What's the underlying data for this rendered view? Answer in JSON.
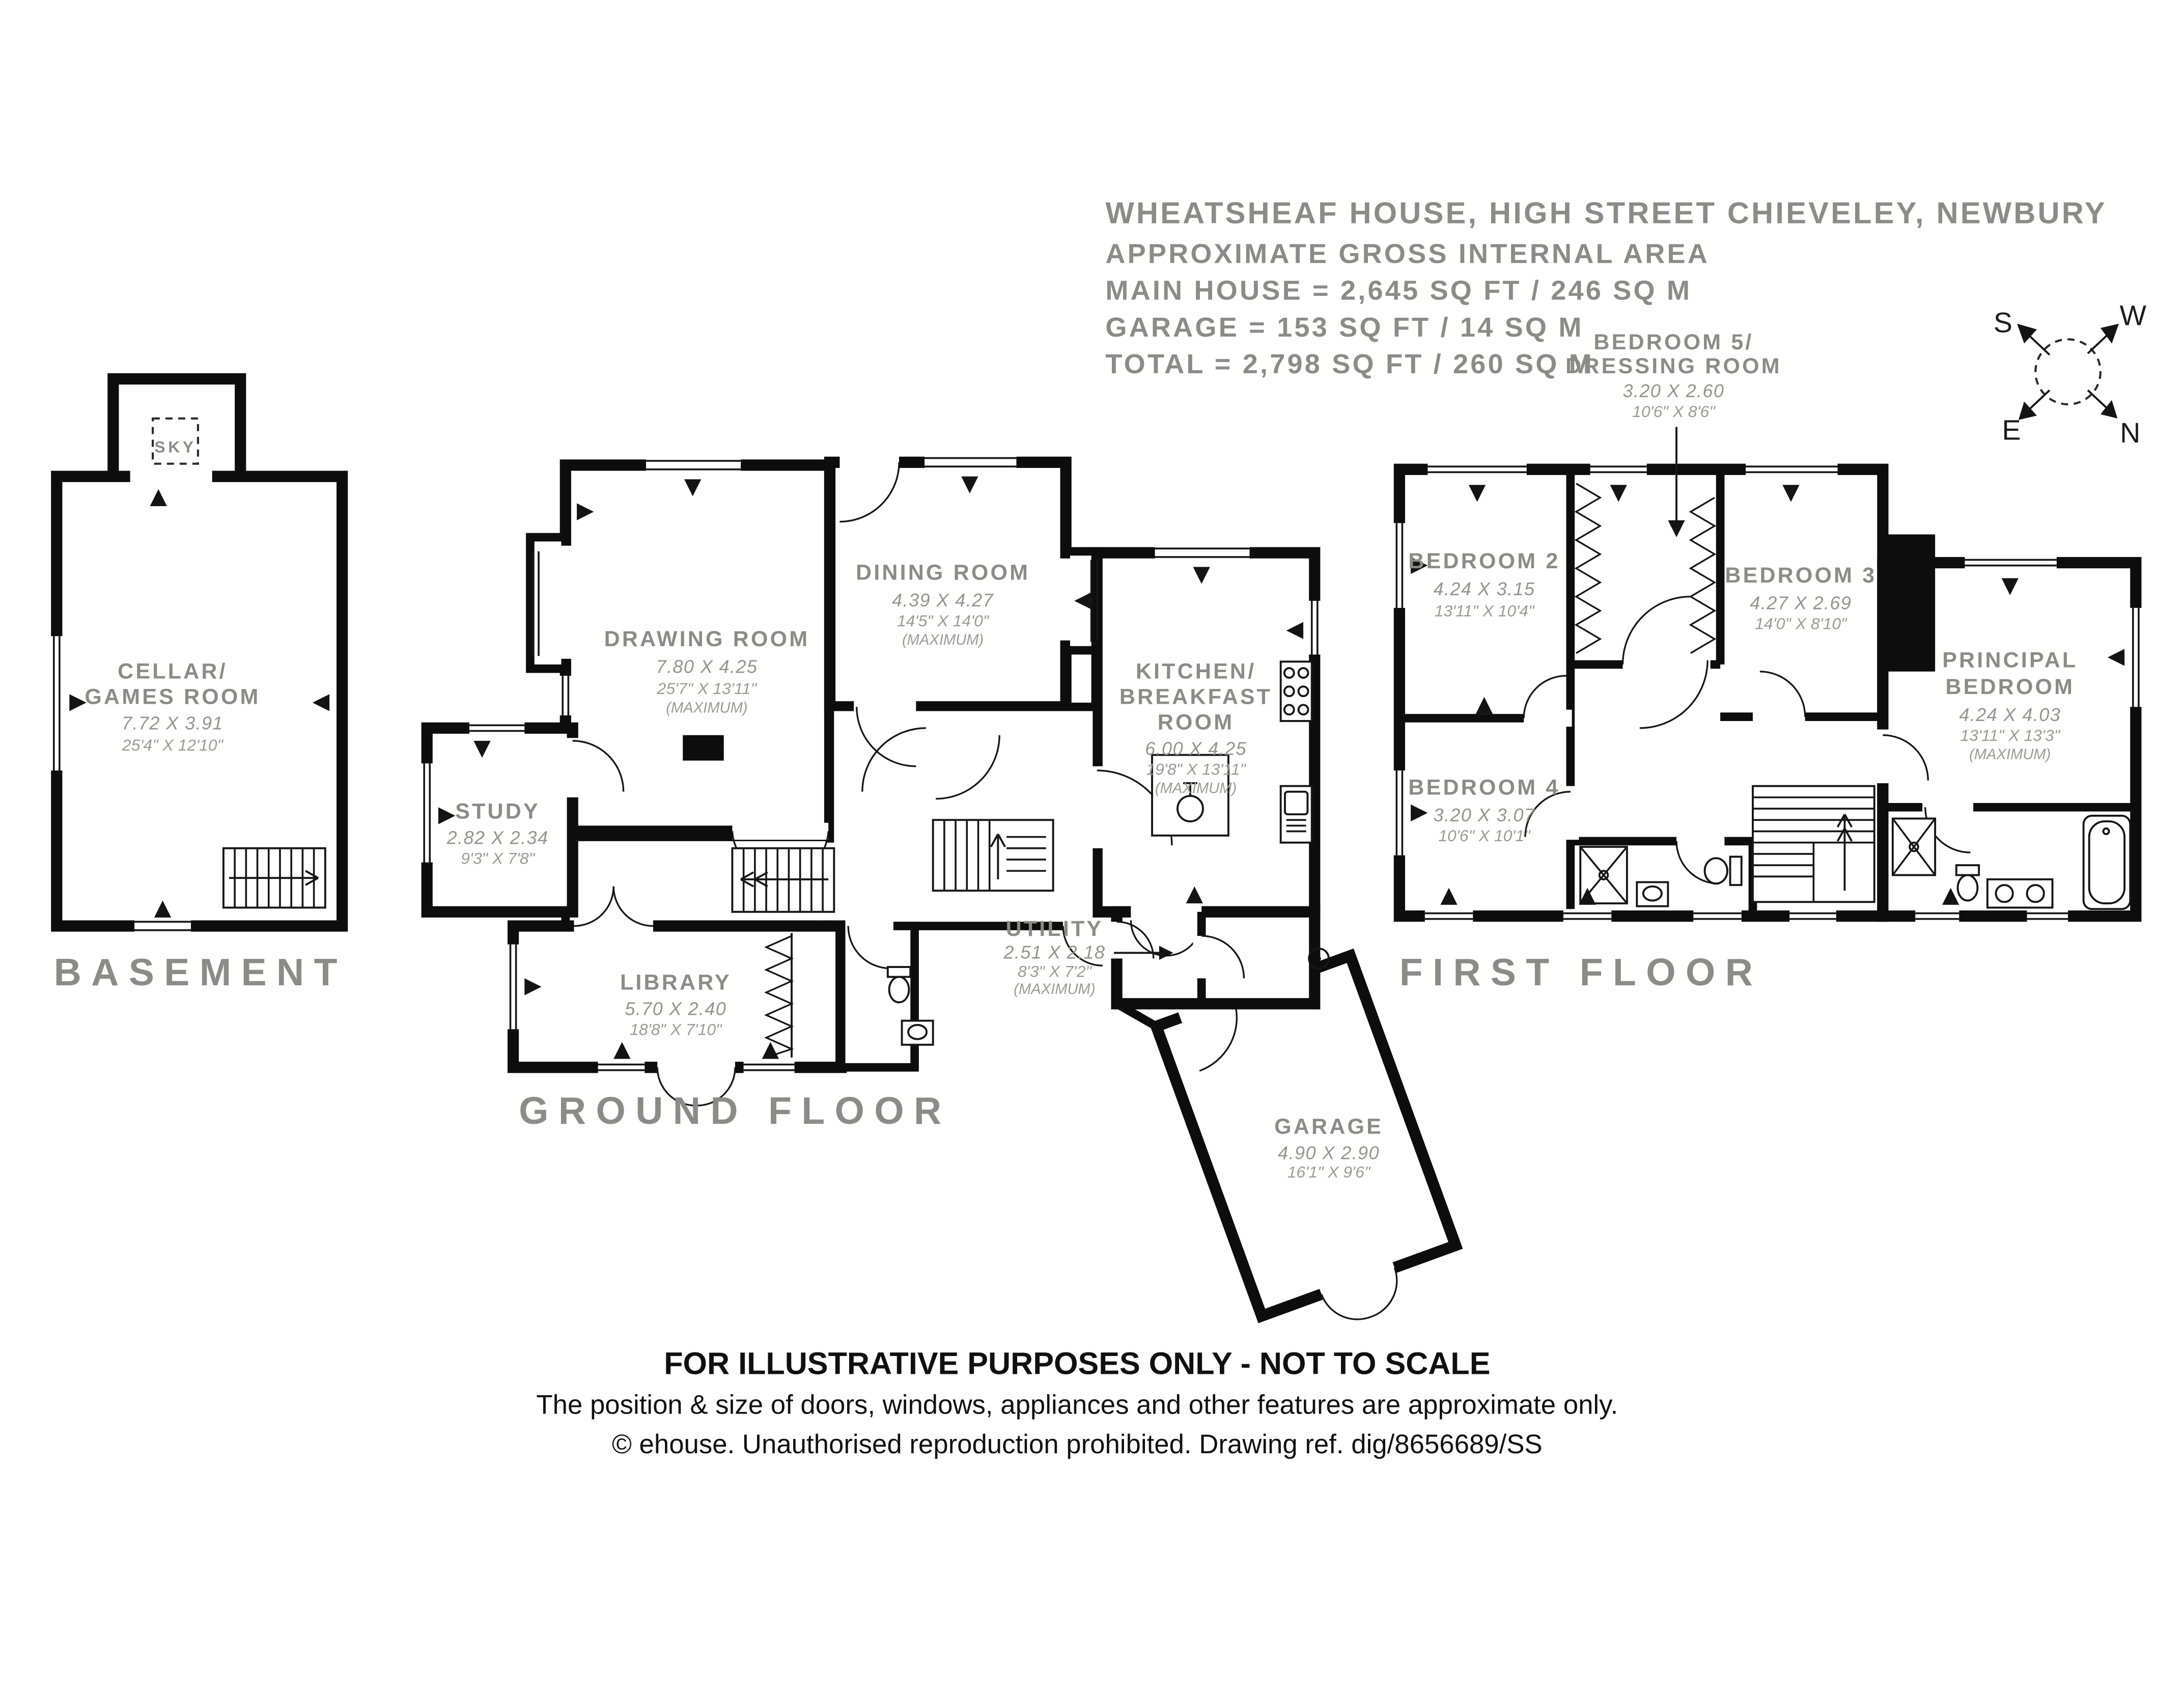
{
  "colors": {
    "wall": "#0d0d0d",
    "label_gray": "#8b8b87",
    "dim_gray": "#94948f",
    "footer_black": "#101010"
  },
  "title": {
    "line1": "WHEATSHEAF HOUSE, HIGH STREET CHIEVELEY, NEWBURY",
    "line2": "APPROXIMATE GROSS INTERNAL AREA",
    "line3": "MAIN HOUSE = 2,645 SQ FT / 246 SQ M",
    "line4": "GARAGE = 153 SQ FT / 14 SQ M",
    "line5": "TOTAL = 2,798 SQ FT / 260 SQ M"
  },
  "compass": {
    "s": "S",
    "w": "W",
    "e": "E",
    "n": "N"
  },
  "floors": {
    "basement": {
      "label": "BASEMENT",
      "sky": "SKY",
      "rooms": {
        "cellar": {
          "name1": "CELLAR/",
          "name2": "GAMES ROOM",
          "metric": "7.72 X 3.91",
          "imperial": "25'4\" X 12'10\""
        }
      }
    },
    "ground": {
      "label": "GROUND FLOOR",
      "rooms": {
        "drawing": {
          "name": "DRAWING ROOM",
          "metric": "7.80 X 4.25",
          "imperial": "25'7\" X 13'11\"",
          "note": "(MAXIMUM)"
        },
        "dining": {
          "name": "DINING ROOM",
          "metric": "4.39 X 4.27",
          "imperial": "14'5\" X 14'0\"",
          "note": "(MAXIMUM)"
        },
        "kitchen": {
          "name1": "KITCHEN/",
          "name2": "BREAKFAST",
          "name3": "ROOM",
          "metric": "6.00 X 4.25",
          "imperial": "19'8\" X 13'11\"",
          "note": "(MAXIMUM)"
        },
        "study": {
          "name": "STUDY",
          "metric": "2.82 X 2.34",
          "imperial": "9'3\" X 7'8\""
        },
        "library": {
          "name": "LIBRARY",
          "metric": "5.70 X 2.40",
          "imperial": "18'8\" X 7'10\""
        },
        "utility": {
          "name": "UTILITY",
          "metric": "2.51 X 2.18",
          "imperial": "8'3\" X 7'2\"",
          "note": "(MAXIMUM)"
        },
        "garage": {
          "name": "GARAGE",
          "metric": "4.90 X 2.90",
          "imperial": "16'1\" X 9'6\""
        }
      }
    },
    "first": {
      "label": "FIRST FLOOR",
      "rooms": {
        "bedroom2": {
          "name": "BEDROOM 2",
          "metric": "4.24 X 3.15",
          "imperial": "13'11\" X 10'4\""
        },
        "bedroom3": {
          "name": "BEDROOM 3",
          "metric": "4.27 X 2.69",
          "imperial": "14'0\" X 8'10\""
        },
        "bedroom4": {
          "name": "BEDROOM 4",
          "metric": "3.20 X 3.07",
          "imperial": "10'6\" X 10'1\""
        },
        "bedroom5": {
          "name1": "BEDROOM 5/",
          "name2": "DRESSING ROOM",
          "metric": "3.20 X 2.60",
          "imperial": "10'6\" X 8'6\""
        },
        "principal": {
          "name1": "PRINCIPAL",
          "name2": "BEDROOM",
          "metric": "4.24 X 4.03",
          "imperial": "13'11\" X 13'3\"",
          "note": "(MAXIMUM)"
        }
      }
    }
  },
  "footer": {
    "line1": "FOR ILLUSTRATIVE PURPOSES ONLY - NOT TO SCALE",
    "line2": "The position & size of doors, windows, appliances and other features are approximate only.",
    "line3": "© ehouse. Unauthorised reproduction prohibited. Drawing ref. dig/8656689/SS"
  }
}
